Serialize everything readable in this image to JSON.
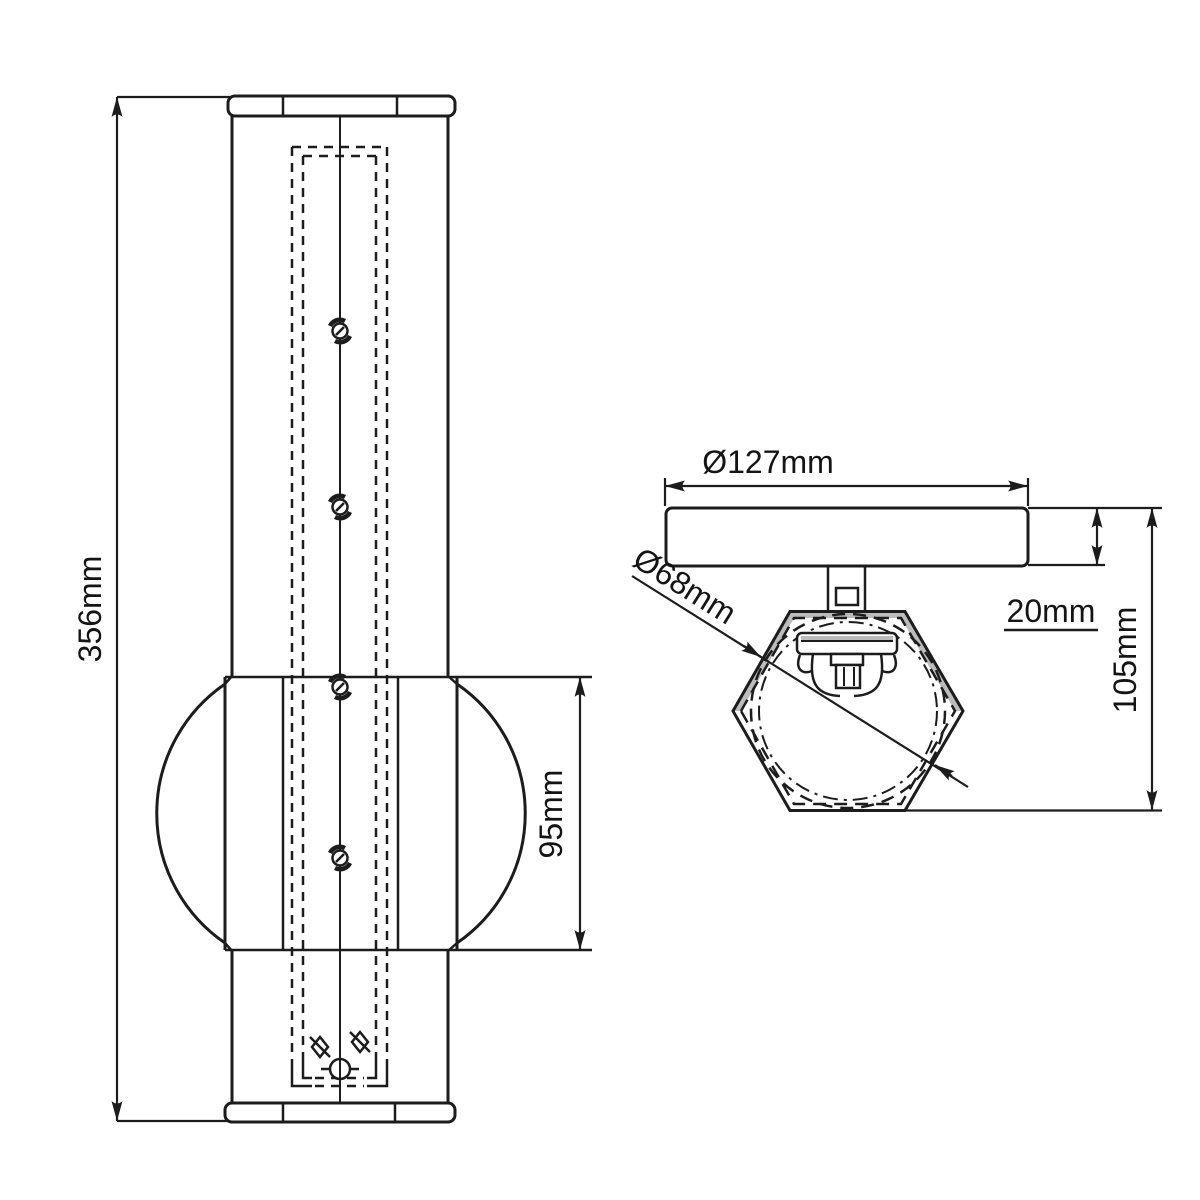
{
  "drawing": {
    "kind": "technical-dimension-drawing",
    "colors": {
      "ink": "#1c1c1c",
      "background": "#ffffff",
      "shading": "#bcbcbc"
    },
    "views": {
      "front": {
        "dimensions": {
          "overall_height": "356mm",
          "globe_section_height": "95mm"
        }
      },
      "side": {
        "dimensions": {
          "plate_diameter": "Ø127mm",
          "shade_diameter": "Ø68mm",
          "plate_thickness": "20mm",
          "projection_depth": "105mm"
        }
      }
    }
  }
}
